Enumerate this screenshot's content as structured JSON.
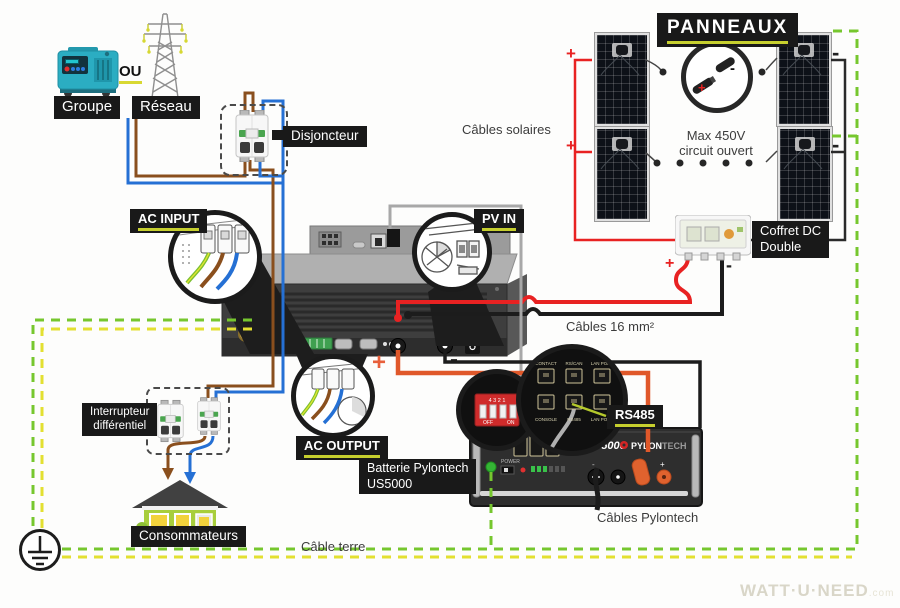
{
  "diagram": {
    "panneaux": "PANNEAUX",
    "groupe": "Groupe",
    "ou": "OU",
    "reseau": "Réseau",
    "disjoncteur": "Disjoncteur",
    "ac_input": "AC INPUT",
    "pv_in": "PV IN",
    "ac_output": "AC OUTPUT",
    "cables_solaires": "Câbles solaires",
    "max_voltage_line1": "Max 450V",
    "max_voltage_line2": "circuit ouvert",
    "coffret_line1": "Coffret DC",
    "coffret_line2": "Double",
    "cables_16": "Câbles 16 mm²",
    "rs485": "RS485",
    "batterie_line1": "Batterie Pylontech",
    "batterie_line2": "US5000",
    "cables_pylontech": "Câbles Pylontech",
    "interrupteur_line1": "Interrupteur",
    "interrupteur_line2": "différentiel",
    "consommateurs": "Consommateurs",
    "cable_terre": "Câble terre"
  },
  "battery": {
    "model": "US5000",
    "brand_bold": "PYLON",
    "brand_light": "TECH",
    "power_label": "POWER",
    "ports_top": [
      "CONTACT",
      "RS/CAN",
      "LAN PORT"
    ],
    "ports_bottom": [
      "CONSOLE",
      "RS485",
      "LAN PORT"
    ],
    "dip_numbers": "4 3 2 1",
    "dip_off": "OFF",
    "dip_on": "ON"
  },
  "signs": {
    "plus": "+",
    "minus": "-"
  },
  "colors": {
    "wire_red": "#e82222",
    "wire_brown": "#8a4f1d",
    "wire_blue": "#2570d4",
    "wire_orange": "#e0582a",
    "wire_gray": "#a8a8a8",
    "wire_black": "#1c1c1c",
    "ground_green": "#76c72e",
    "ground_yellow": "#e3e031",
    "accent_yellow": "#c6cf2e",
    "label_bg": "#191919"
  },
  "footer": {
    "logo": "WATT·U·NEED",
    "logo_suffix": ".com"
  }
}
